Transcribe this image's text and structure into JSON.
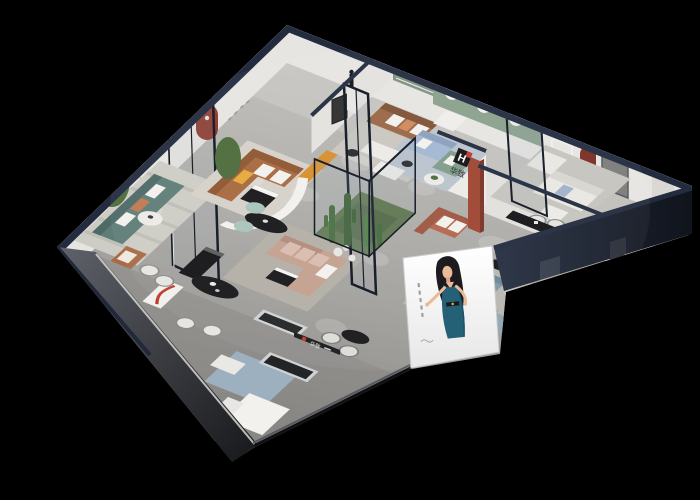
{
  "scene": {
    "title": "Furniture showroom — 3D isometric cutaway render",
    "background": "#000000"
  },
  "brand": {
    "symbol": "H",
    "name": "华致"
  },
  "poster": {
    "subject": "illustrated model in a teal dress",
    "location": "storefront panel"
  },
  "colors": {
    "background": "#000000",
    "floor": "#b0afab",
    "floor_front": "#83827f",
    "floor_back": "#d2d1cd",
    "rug_warm": "#d6d2c9",
    "rug_gray": "#c9c7c0",
    "rug_blue": "#9db0bf",
    "rug_blue_light": "#bac3cd",
    "rug_taupe": "#b3afa7",
    "rug_stone": "#c6c4be",
    "wall_navy": "#232c3f",
    "wall_white": "#e6e5e1",
    "wall_green": "#8aa08d",
    "niche_green": "#7d9183",
    "niche_red": "#8d372c",
    "niche_dark_red": "#7a2d24",
    "glass_frame": "#0f1522",
    "outer_dark": "#1a1b1e",
    "sofa_teal": "#5f7d78",
    "sofa_caramel": "#a8693f",
    "sofa_brown": "#9a6746",
    "sofa_blush": "#c4a090",
    "sofa_blue": "#a3b7d1",
    "sofa_green": "#7f9d8a",
    "sofa_white": "#e9e7e1",
    "sofa_terracotta": "#b4674e",
    "sofa_bluegray": "#7f98a4",
    "chair_leather": "#a76b46",
    "pillow_white": "#f2f1ee",
    "pillow_orange": "#c07a50",
    "pillow_yellow": "#e6a93c",
    "table_black": "#17181a",
    "table_white": "#ecebe7",
    "bench_metal": "#cfd1d4",
    "console_black": "#141416",
    "plant_green": "#4c6b3b",
    "cactus_green": "#3e6632",
    "garden_ground": "#5c7348",
    "accent_orange": "#d88f2e",
    "brand_red": "#c0392b",
    "rust_column": "#9e4432",
    "poster_dress": "#1c5a70",
    "skin_tone": "#eab795"
  },
  "rooms": [
    {
      "name": "lounge-teal",
      "furniture": [
        "teal three-seat sofa",
        "leather armchair",
        "round side table",
        "potted plant",
        "striped rug",
        "rounded wall line decor"
      ]
    },
    {
      "name": "living-caramel",
      "furniture": [
        "caramel leather L-sofa",
        "black coffee table",
        "yellow pillow",
        "arched red wall niche",
        "tall glass partition"
      ]
    },
    {
      "name": "living-brown",
      "furniture": [
        "brown leather sofa",
        "white armchair",
        "white display tables",
        "sculpture stand",
        "orange bench",
        "recessed green wall niche"
      ]
    },
    {
      "name": "showcase-green-arches",
      "furniture": [
        "light blue sofa",
        "green loveseat",
        "round table",
        "three arched wall panels on sage wall"
      ]
    },
    {
      "name": "suite-white-one",
      "furniture": [
        "white fabric sofas",
        "white coffee table",
        "black media console with brand mark"
      ]
    },
    {
      "name": "suite-white-two",
      "furniture": [
        "white sectional",
        "arched dark-red niche",
        "grey door",
        "white door frame"
      ]
    },
    {
      "name": "center-lounge",
      "furniture": [
        "blush sectional sofa",
        "black coffee table",
        "curved white partition",
        "black oval table",
        "mint chairs",
        "glass cactus garden"
      ]
    },
    {
      "name": "brand-corner",
      "furniture": [
        "logo partition wall",
        "terracotta sofa",
        "rust display column"
      ]
    },
    {
      "name": "family-corner",
      "furniture": [
        "blue-grey sofa pair",
        "ottoman",
        "round black table"
      ]
    },
    {
      "name": "dining-front",
      "furniture": [
        "black oval dining table",
        "white chairs",
        "shelf with red curve",
        "black sideboard",
        "metal benches",
        "white corner sofa",
        "blue rug",
        "storefront sign",
        "model poster"
      ]
    }
  ]
}
